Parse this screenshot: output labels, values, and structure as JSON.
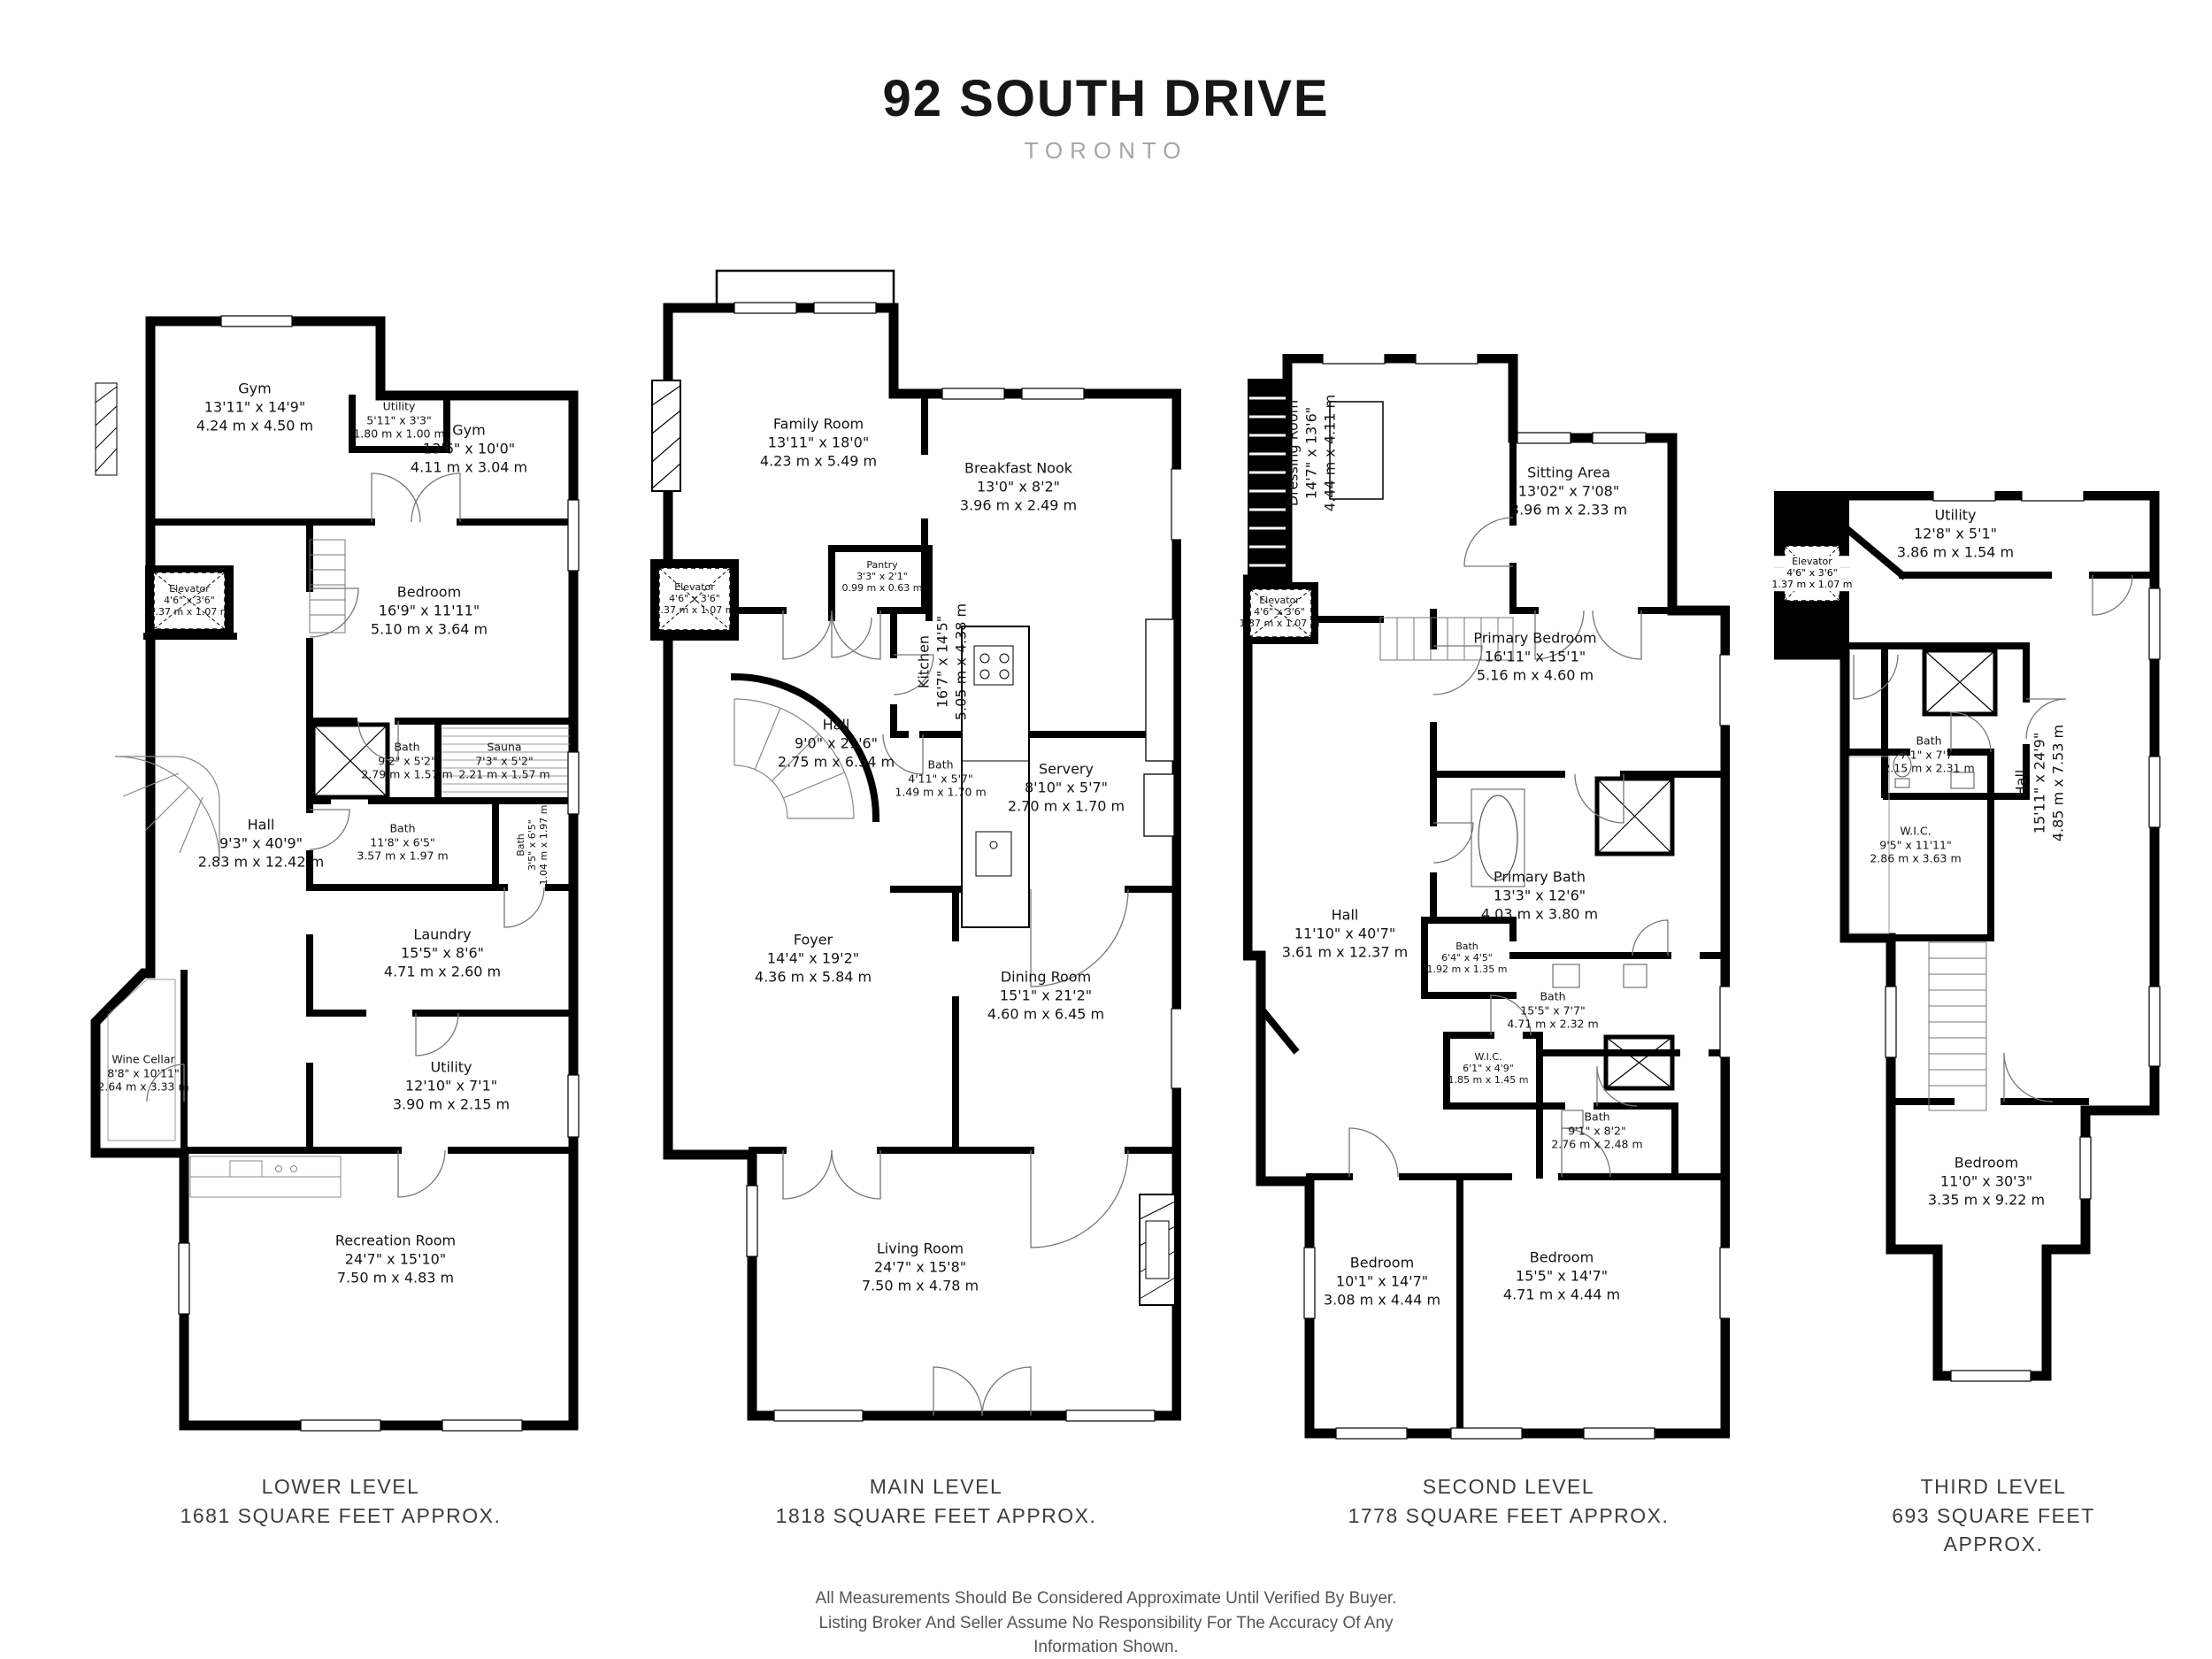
{
  "title": "92 SOUTH DRIVE",
  "subtitle": "TORONTO",
  "disclaimer": {
    "lines": [
      "All Measurements Should Be Considered Approximate Until Verified By Buyer.",
      "Listing Broker And Seller Assume No Responsibility For The Accuracy Of Any",
      "Information Shown."
    ]
  },
  "levels": [
    {
      "name": "LOWER LEVEL",
      "area": "1681 SQUARE FEET APPROX.",
      "rooms": [
        {
          "label": "Gym",
          "imperial": "13'11\" x 14'9\"",
          "metric": "4.24 m x 4.50 m"
        },
        {
          "label": "Utility",
          "imperial": "5'11\" x 3'3\"",
          "metric": "1.80 m x 1.00 m"
        },
        {
          "label": "Gym",
          "imperial": "13'6\" x 10'0\"",
          "metric": "4.11 m x 3.04 m"
        },
        {
          "label": "Elevator",
          "imperial": "4'6\" x 3'6\"",
          "metric": "1.37 m x 1.07 m"
        },
        {
          "label": "Bedroom",
          "imperial": "16'9\" x 11'11\"",
          "metric": "5.10 m x 3.64 m"
        },
        {
          "label": "Bath",
          "imperial": "9'2\" x 5'2\"",
          "metric": "2.79 m x 1.57 m"
        },
        {
          "label": "Sauna",
          "imperial": "7'3\" x 5'2\"",
          "metric": "2.21 m x 1.57 m"
        },
        {
          "label": "Bath",
          "imperial": "11'8\" x 6'5\"",
          "metric": "3.57 m x 1.97 m"
        },
        {
          "label": "Bath",
          "imperial": "3'5\" x 6'5\"",
          "metric": "1.04 m x 1.97 m"
        },
        {
          "label": "Hall",
          "imperial": "9'3\" x 40'9\"",
          "metric": "2.83 m x 12.42 m"
        },
        {
          "label": "Laundry",
          "imperial": "15'5\" x 8'6\"",
          "metric": "4.71 m x 2.60 m"
        },
        {
          "label": "Wine Cellar",
          "imperial": "8'8\" x 10'11\"",
          "metric": "2.64 m x 3.33 m"
        },
        {
          "label": "Utility",
          "imperial": "12'10\" x 7'1\"",
          "metric": "3.90 m x 2.15 m"
        },
        {
          "label": "Recreation Room",
          "imperial": "24'7\" x 15'10\"",
          "metric": "7.50 m x 4.83 m"
        }
      ]
    },
    {
      "name": "MAIN LEVEL",
      "area": "1818 SQUARE FEET APPROX.",
      "rooms": [
        {
          "label": "Family Room",
          "imperial": "13'11\" x 18'0\"",
          "metric": "4.23 m x 5.49 m"
        },
        {
          "label": "Breakfast Nook",
          "imperial": "13'0\" x 8'2\"",
          "metric": "3.96 m x 2.49 m"
        },
        {
          "label": "Elevator",
          "imperial": "4'6\" x 3'6\"",
          "metric": "1.37 m x 1.07 m"
        },
        {
          "label": "Pantry",
          "imperial": "3'3\" x 2'1\"",
          "metric": "0.99 m x 0.63 m"
        },
        {
          "label": "Kitchen",
          "imperial": "16'7\" x 14'5\"",
          "metric": "5.05 m x 4.38 m"
        },
        {
          "label": "Hall",
          "imperial": "9'0\" x 21'6\"",
          "metric": "2.75 m x 6.54 m"
        },
        {
          "label": "Bath",
          "imperial": "4'11\" x 5'7\"",
          "metric": "1.49 m x 1.70 m"
        },
        {
          "label": "Servery",
          "imperial": "8'10\" x 5'7\"",
          "metric": "2.70 m x 1.70 m"
        },
        {
          "label": "Foyer",
          "imperial": "14'4\" x 19'2\"",
          "metric": "4.36 m x 5.84 m"
        },
        {
          "label": "Dining Room",
          "imperial": "15'1\" x 21'2\"",
          "metric": "4.60 m x 6.45 m"
        },
        {
          "label": "Living Room",
          "imperial": "24'7\" x 15'8\"",
          "metric": "7.50 m x 4.78 m"
        }
      ]
    },
    {
      "name": "SECOND LEVEL",
      "area": "1778 SQUARE FEET APPROX.",
      "rooms": [
        {
          "label": "Dressing Room",
          "imperial": "14'7\" x 13'6\"",
          "metric": "4.44 m x 4.11 m"
        },
        {
          "label": "Sitting Area",
          "imperial": "13'02\" x 7'08\"",
          "metric": "3.96 m x 2.33 m"
        },
        {
          "label": "Elevator",
          "imperial": "4'6\" x 3'6\"",
          "metric": "1.37 m x 1.07 m"
        },
        {
          "label": "Primary Bedroom",
          "imperial": "16'11\" x 15'1\"",
          "metric": "5.16 m x 4.60 m"
        },
        {
          "label": "Primary Bath",
          "imperial": "13'3\" x 12'6\"",
          "metric": "4.03 m x 3.80 m"
        },
        {
          "label": "Hall",
          "imperial": "11'10\" x 40'7\"",
          "metric": "3.61 m x 12.37 m"
        },
        {
          "label": "Bath",
          "imperial": "6'4\" x 4'5\"",
          "metric": "1.92 m x 1.35 m"
        },
        {
          "label": "Bath",
          "imperial": "15'5\" x 7'7\"",
          "metric": "4.71 m x 2.32 m"
        },
        {
          "label": "W.I.C.",
          "imperial": "6'1\" x 4'9\"",
          "metric": "1.85 m x 1.45 m"
        },
        {
          "label": "Bath",
          "imperial": "9'1\" x 8'2\"",
          "metric": "2.76 m x 2.48 m"
        },
        {
          "label": "Bedroom",
          "imperial": "10'1\" x 14'7\"",
          "metric": "3.08 m x 4.44 m"
        },
        {
          "label": "Bedroom",
          "imperial": "15'5\" x 14'7\"",
          "metric": "4.71 m x 4.44 m"
        }
      ]
    },
    {
      "name": "THIRD LEVEL",
      "area": "693 SQUARE FEET APPROX.",
      "rooms": [
        {
          "label": "Utility",
          "imperial": "12'8\" x 5'1\"",
          "metric": "3.86 m x 1.54 m"
        },
        {
          "label": "Elevator",
          "imperial": "4'6\" x 3'6\"",
          "metric": "1.37 m x 1.07 m"
        },
        {
          "label": "Bath",
          "imperial": "7'1\" x 7'7\"",
          "metric": "2.15 m x 2.31 m"
        },
        {
          "label": "W.I.C.",
          "imperial": "9'5\" x 11'11\"",
          "metric": "2.86 m x 3.63 m"
        },
        {
          "label": "Hall",
          "imperial": "15'11\" x 24'9\"",
          "metric": "4.85 m x 7.53 m"
        },
        {
          "label": "Bedroom",
          "imperial": "11'0\" x 30'3\"",
          "metric": "3.35 m x 9.22 m"
        }
      ]
    }
  ]
}
